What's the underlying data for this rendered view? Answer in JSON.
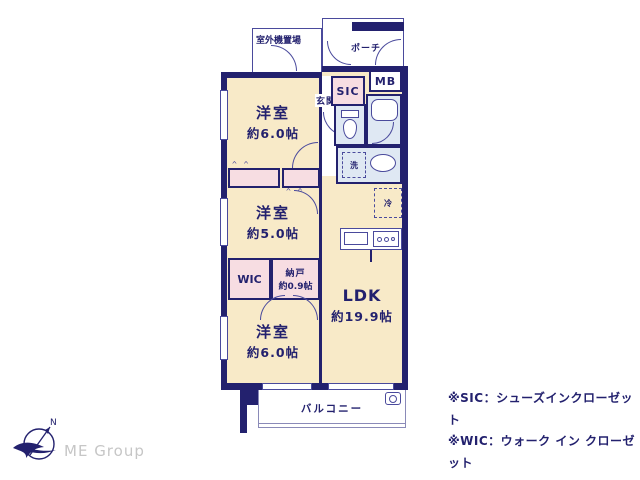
{
  "colors": {
    "wall": "#23216e",
    "line": "#4a4a9c",
    "room_fill": "#f8eac8",
    "closet_fill": "#f7dde2",
    "wet_area_fill": "#dfe8f3",
    "text": "#23216e",
    "logo_gray": "#c6c6c6"
  },
  "exterior": {
    "outdoor_unit_label": "室外機置場",
    "porch_label": "ポーチ",
    "balcony_label": "バルコニー"
  },
  "entrance": {
    "genkan_label": "玄関",
    "sic_label": "SIC",
    "mb_label": "MB"
  },
  "rooms": {
    "bedroom_top": {
      "name": "洋室",
      "size": "約6.0帖"
    },
    "bedroom_mid": {
      "name": "洋室",
      "size": "約5.0帖"
    },
    "bedroom_bottom": {
      "name": "洋室",
      "size": "約6.0帖"
    },
    "ldk": {
      "name": "LDK",
      "size": "約19.9帖"
    },
    "wic_label": "WIC",
    "storage": {
      "name": "納戸",
      "size": "約0.9帖"
    }
  },
  "fixtures": {
    "washer_label": "洗",
    "fridge_label": "冷"
  },
  "notes": {
    "sic": "※SIC：シューズインクローゼット",
    "wic": "※WIC：ウォーク イン クローゼット"
  },
  "logo": {
    "company": "ME Group",
    "north_label": "N"
  }
}
